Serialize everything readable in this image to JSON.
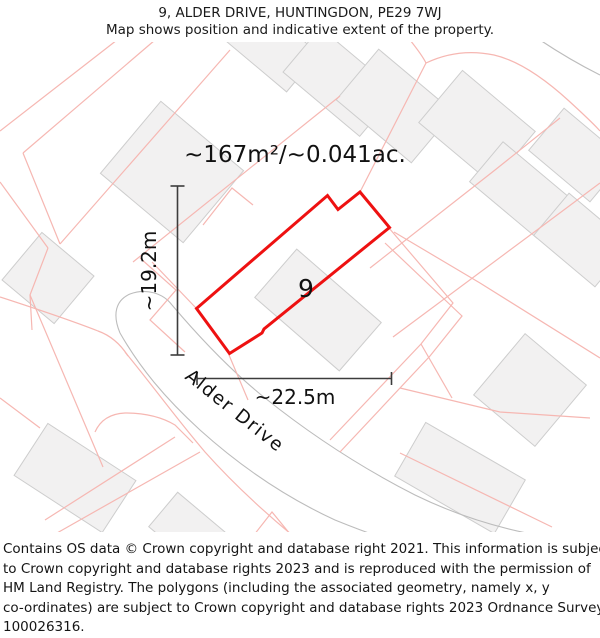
{
  "header": {
    "title": "9, ALDER DRIVE, HUNTINGDON, PE29 7WJ",
    "subtitle": "Map shows position and indicative extent of the property."
  },
  "map": {
    "area_label": "~167m²/~0.041ac.",
    "plot_number": "9",
    "street_name": "Alder Drive",
    "dim_vertical": "~19.2m",
    "dim_horizontal": "~22.5m",
    "colors": {
      "property_outline": "#ee1111",
      "parcel_line": "#f6b7b2",
      "building_fill": "#f2f1f1",
      "building_stroke": "#cdcdcd",
      "road_line": "#bcbcbc",
      "street_label": "#a8a8a8",
      "dimension_line": "#3c3c3c"
    }
  },
  "footer": {
    "lines": [
      "Contains OS data © Crown copyright and database right 2021. This information is subject",
      "to Crown copyright and database rights 2023 and is reproduced with the permission of",
      "HM Land Registry. The polygons (including the associated geometry, namely x, y",
      "co-ordinates) are subject to Crown copyright and database rights 2023 Ordnance Survey",
      "100026316."
    ]
  }
}
